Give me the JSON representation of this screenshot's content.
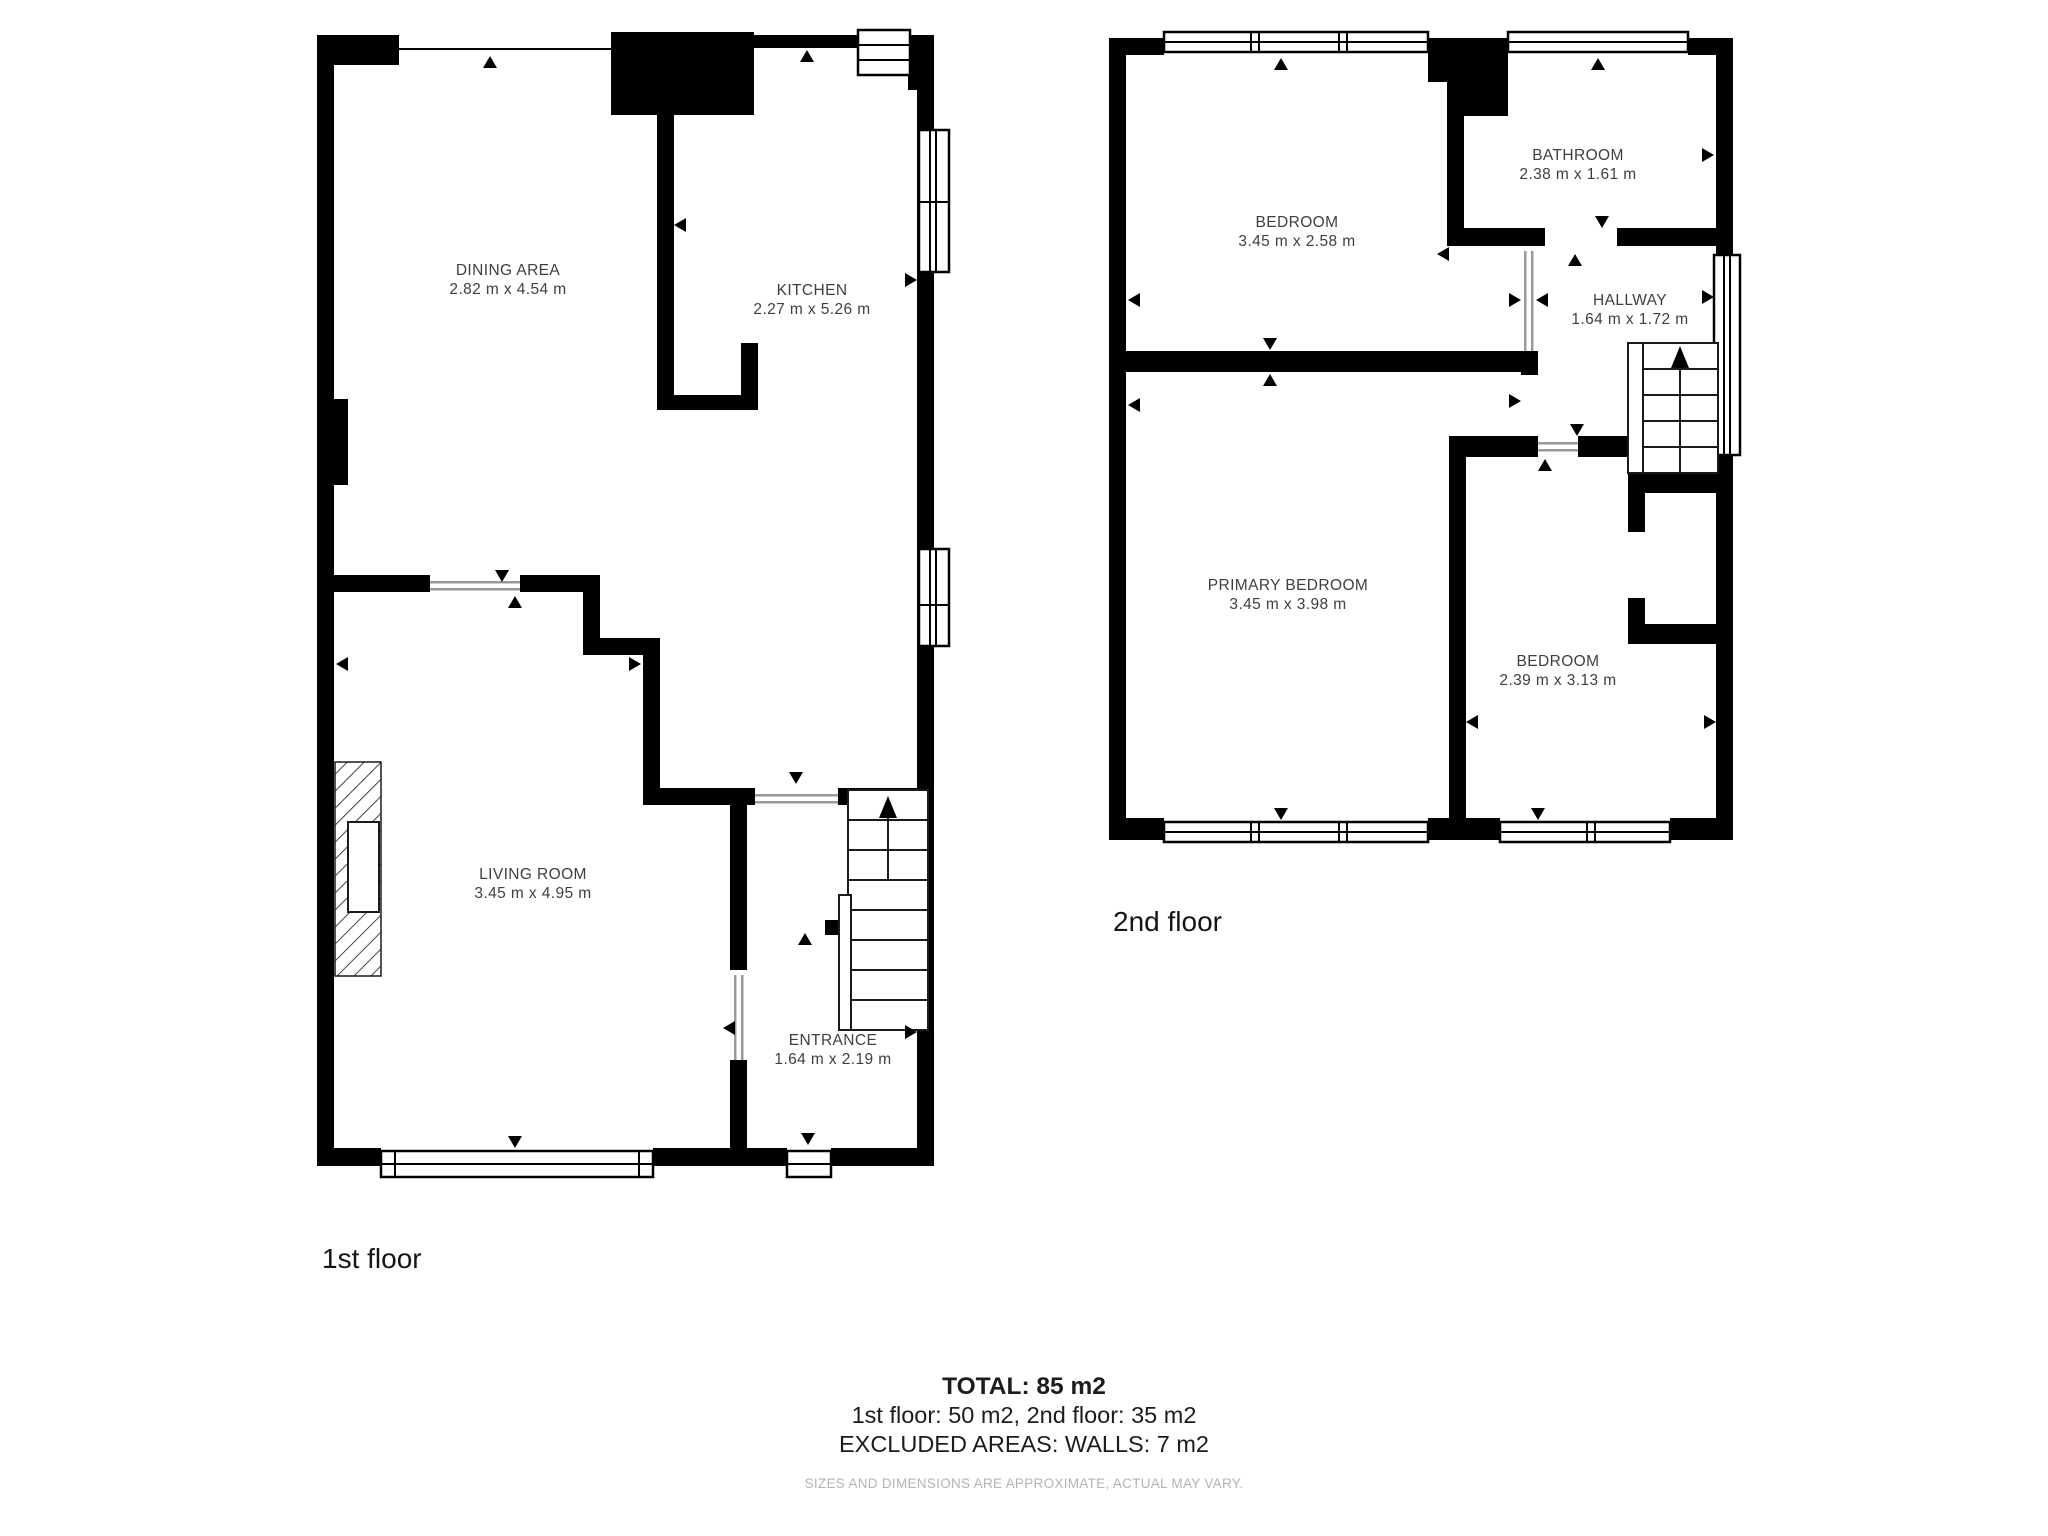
{
  "floors": [
    {
      "name": "1st floor",
      "rooms": [
        {
          "label": "DINING AREA",
          "dims": "2.82 m x 4.54 m"
        },
        {
          "label": "KITCHEN",
          "dims": "2.27 m x 5.26 m"
        },
        {
          "label": "LIVING ROOM",
          "dims": "3.45 m x 4.95 m"
        },
        {
          "label": "ENTRANCE",
          "dims": "1.64 m x 2.19 m"
        }
      ]
    },
    {
      "name": "2nd floor",
      "rooms": [
        {
          "label": "BEDROOM",
          "dims": "3.45 m x 2.58 m"
        },
        {
          "label": "BATHROOM",
          "dims": "2.38 m x 1.61 m"
        },
        {
          "label": "HALLWAY",
          "dims": "1.64 m x 1.72 m"
        },
        {
          "label": "PRIMARY BEDROOM",
          "dims": "3.45 m x 3.98 m"
        },
        {
          "label": "BEDROOM",
          "dims": "2.39 m x 3.13 m"
        }
      ]
    }
  ],
  "summary": {
    "total": "TOTAL: 85 m2",
    "floors_line": "1st floor: 50 m2, 2nd floor: 35 m2",
    "excluded": "EXCLUDED AREAS: WALLS: 7 m2",
    "disclaimer": "SIZES AND DIMENSIONS ARE APPROXIMATE, ACTUAL MAY VARY."
  },
  "colors": {
    "wall": "#000000",
    "room_label": "#3f3f3f",
    "summary_text": "#1c1c1c",
    "disclaimer_text": "#b3b3b3"
  }
}
